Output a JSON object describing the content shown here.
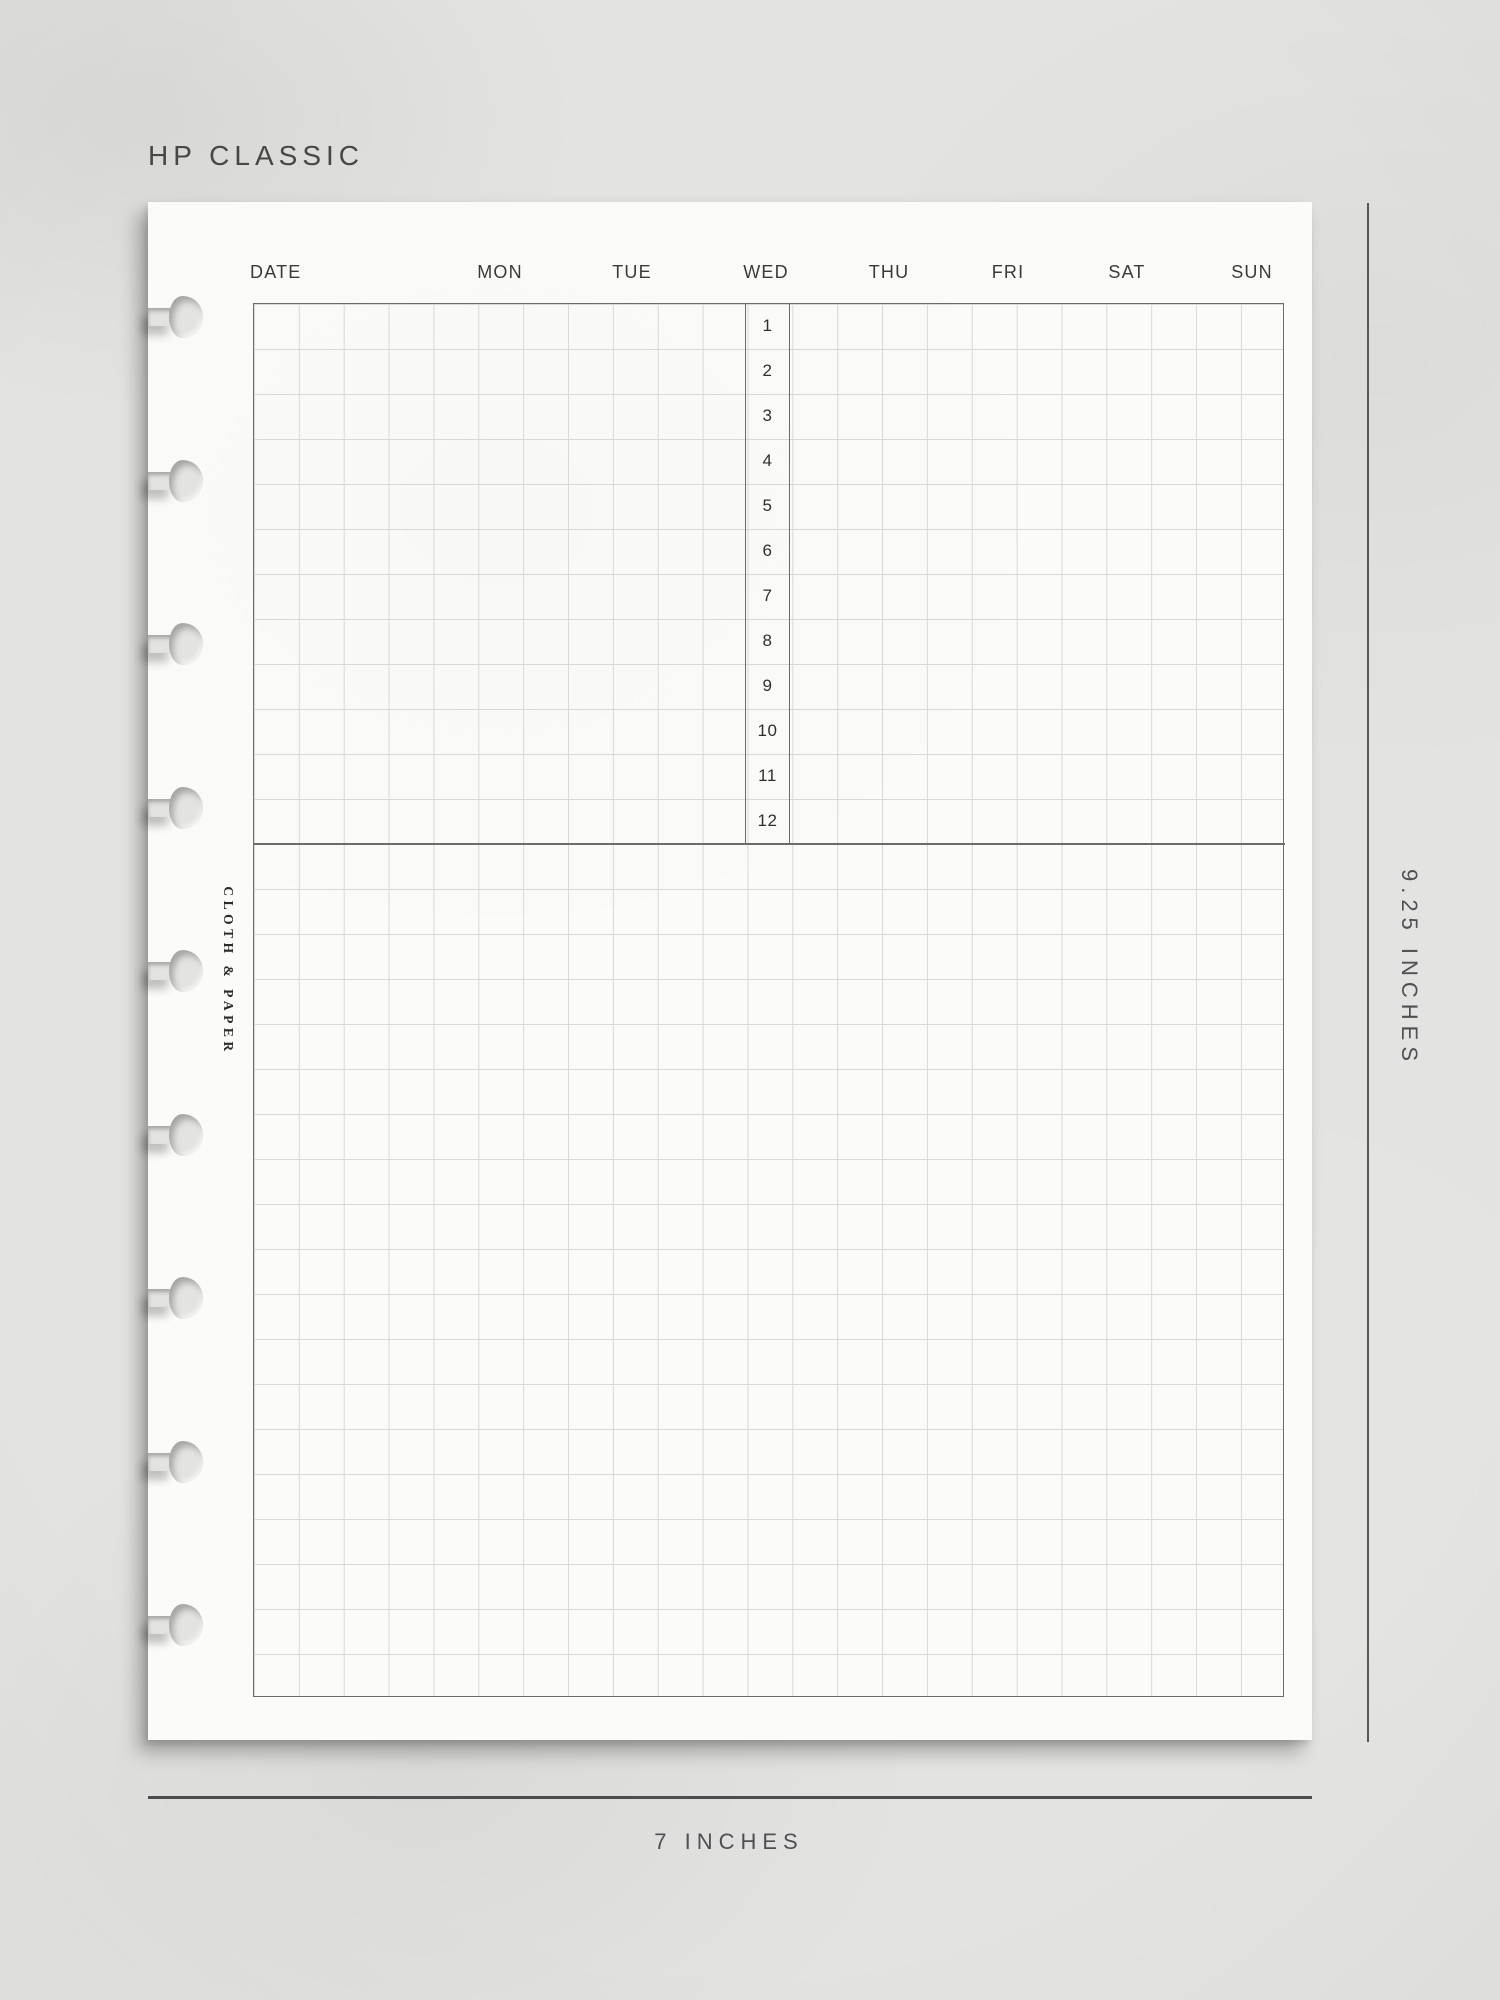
{
  "title": "HP CLASSIC",
  "page": {
    "header": {
      "date_label": "DATE",
      "days": [
        "MON",
        "TUE",
        "WED",
        "THU",
        "FRI",
        "SAT",
        "SUN"
      ]
    },
    "time_column": {
      "hours": [
        "1",
        "2",
        "3",
        "4",
        "5",
        "6",
        "7",
        "8",
        "9",
        "10",
        "11",
        "12"
      ]
    },
    "brand_label": "CLOTH & PAPER"
  },
  "dimensions": {
    "height_label": "9.25 INCHES",
    "width_label": "7 INCHES"
  },
  "colors": {
    "background": "#e3e3e1",
    "paper": "#fbfbf9",
    "grid_line": "#d8d9d6",
    "heavy_border": "#6b6b6b",
    "label_text": "#3a3a3a",
    "dimension_text": "#4e5153"
  }
}
